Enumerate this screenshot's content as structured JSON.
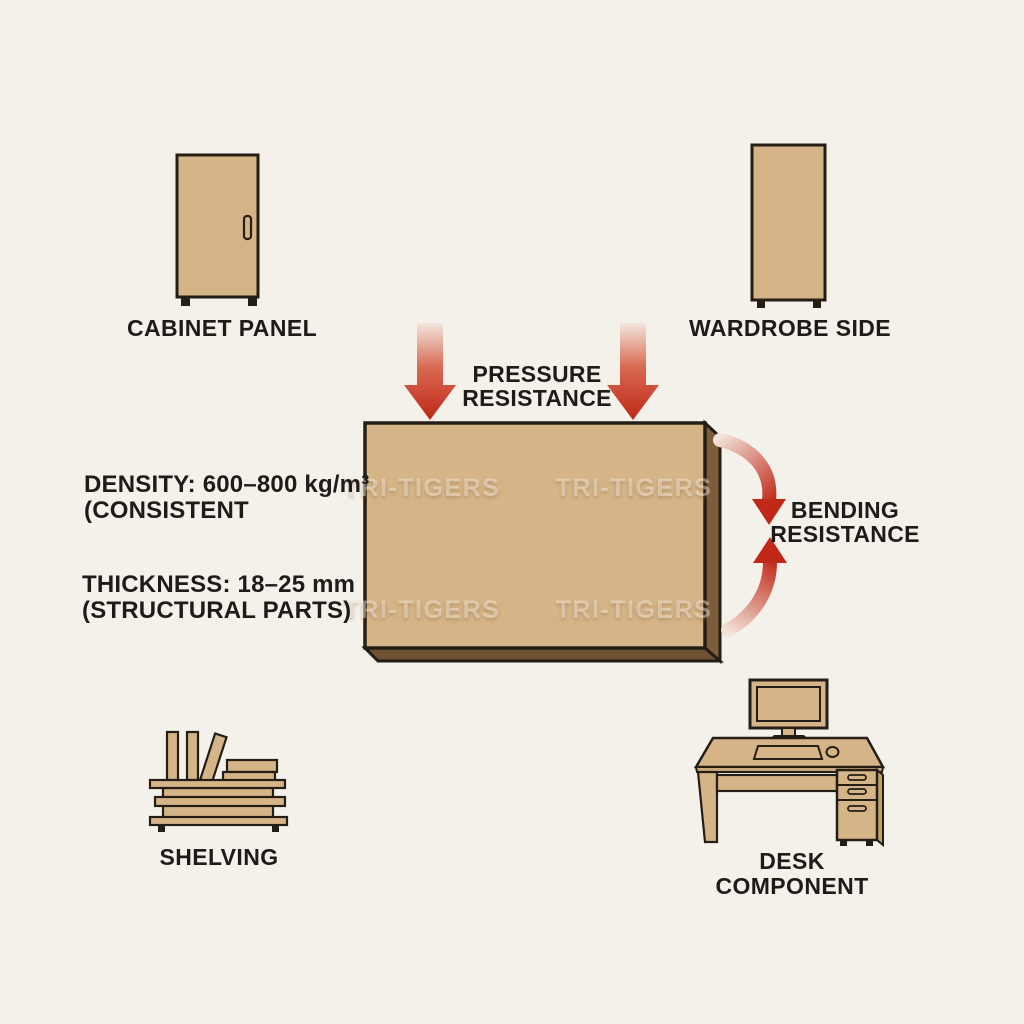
{
  "canvas": {
    "background": "#f4f1ea",
    "watermark": "TRI-TIGERS"
  },
  "colors": {
    "board_fill": "#d5b487",
    "board_edge_dark": "#7e5d39",
    "board_edge_bottom": "#6f5232",
    "outline": "#241e16",
    "arrow_red": "#c02818",
    "arrow_red_light": "#f2e3da",
    "label_text": "#1e1c19"
  },
  "labels": {
    "cabinet_panel": "CABINET PANEL",
    "wardrobe_side": "WARDROBE SIDE",
    "shelving": "SHELVING",
    "desk_component": "DESK COMPONENT"
  },
  "annotations": {
    "pressure_line1": "PRESSURE",
    "pressure_line2": "RESISTANCE",
    "bending_line1": "BENDING",
    "bending_line2": "RESISTANCE",
    "density_line1": "DENSITY: 600–800 kg/m³",
    "density_line2": "(CONSISTENT",
    "thickness_line1": "THICKNESS: 18–25 mm",
    "thickness_line2": "(STRUCTURAL PARTS)"
  }
}
